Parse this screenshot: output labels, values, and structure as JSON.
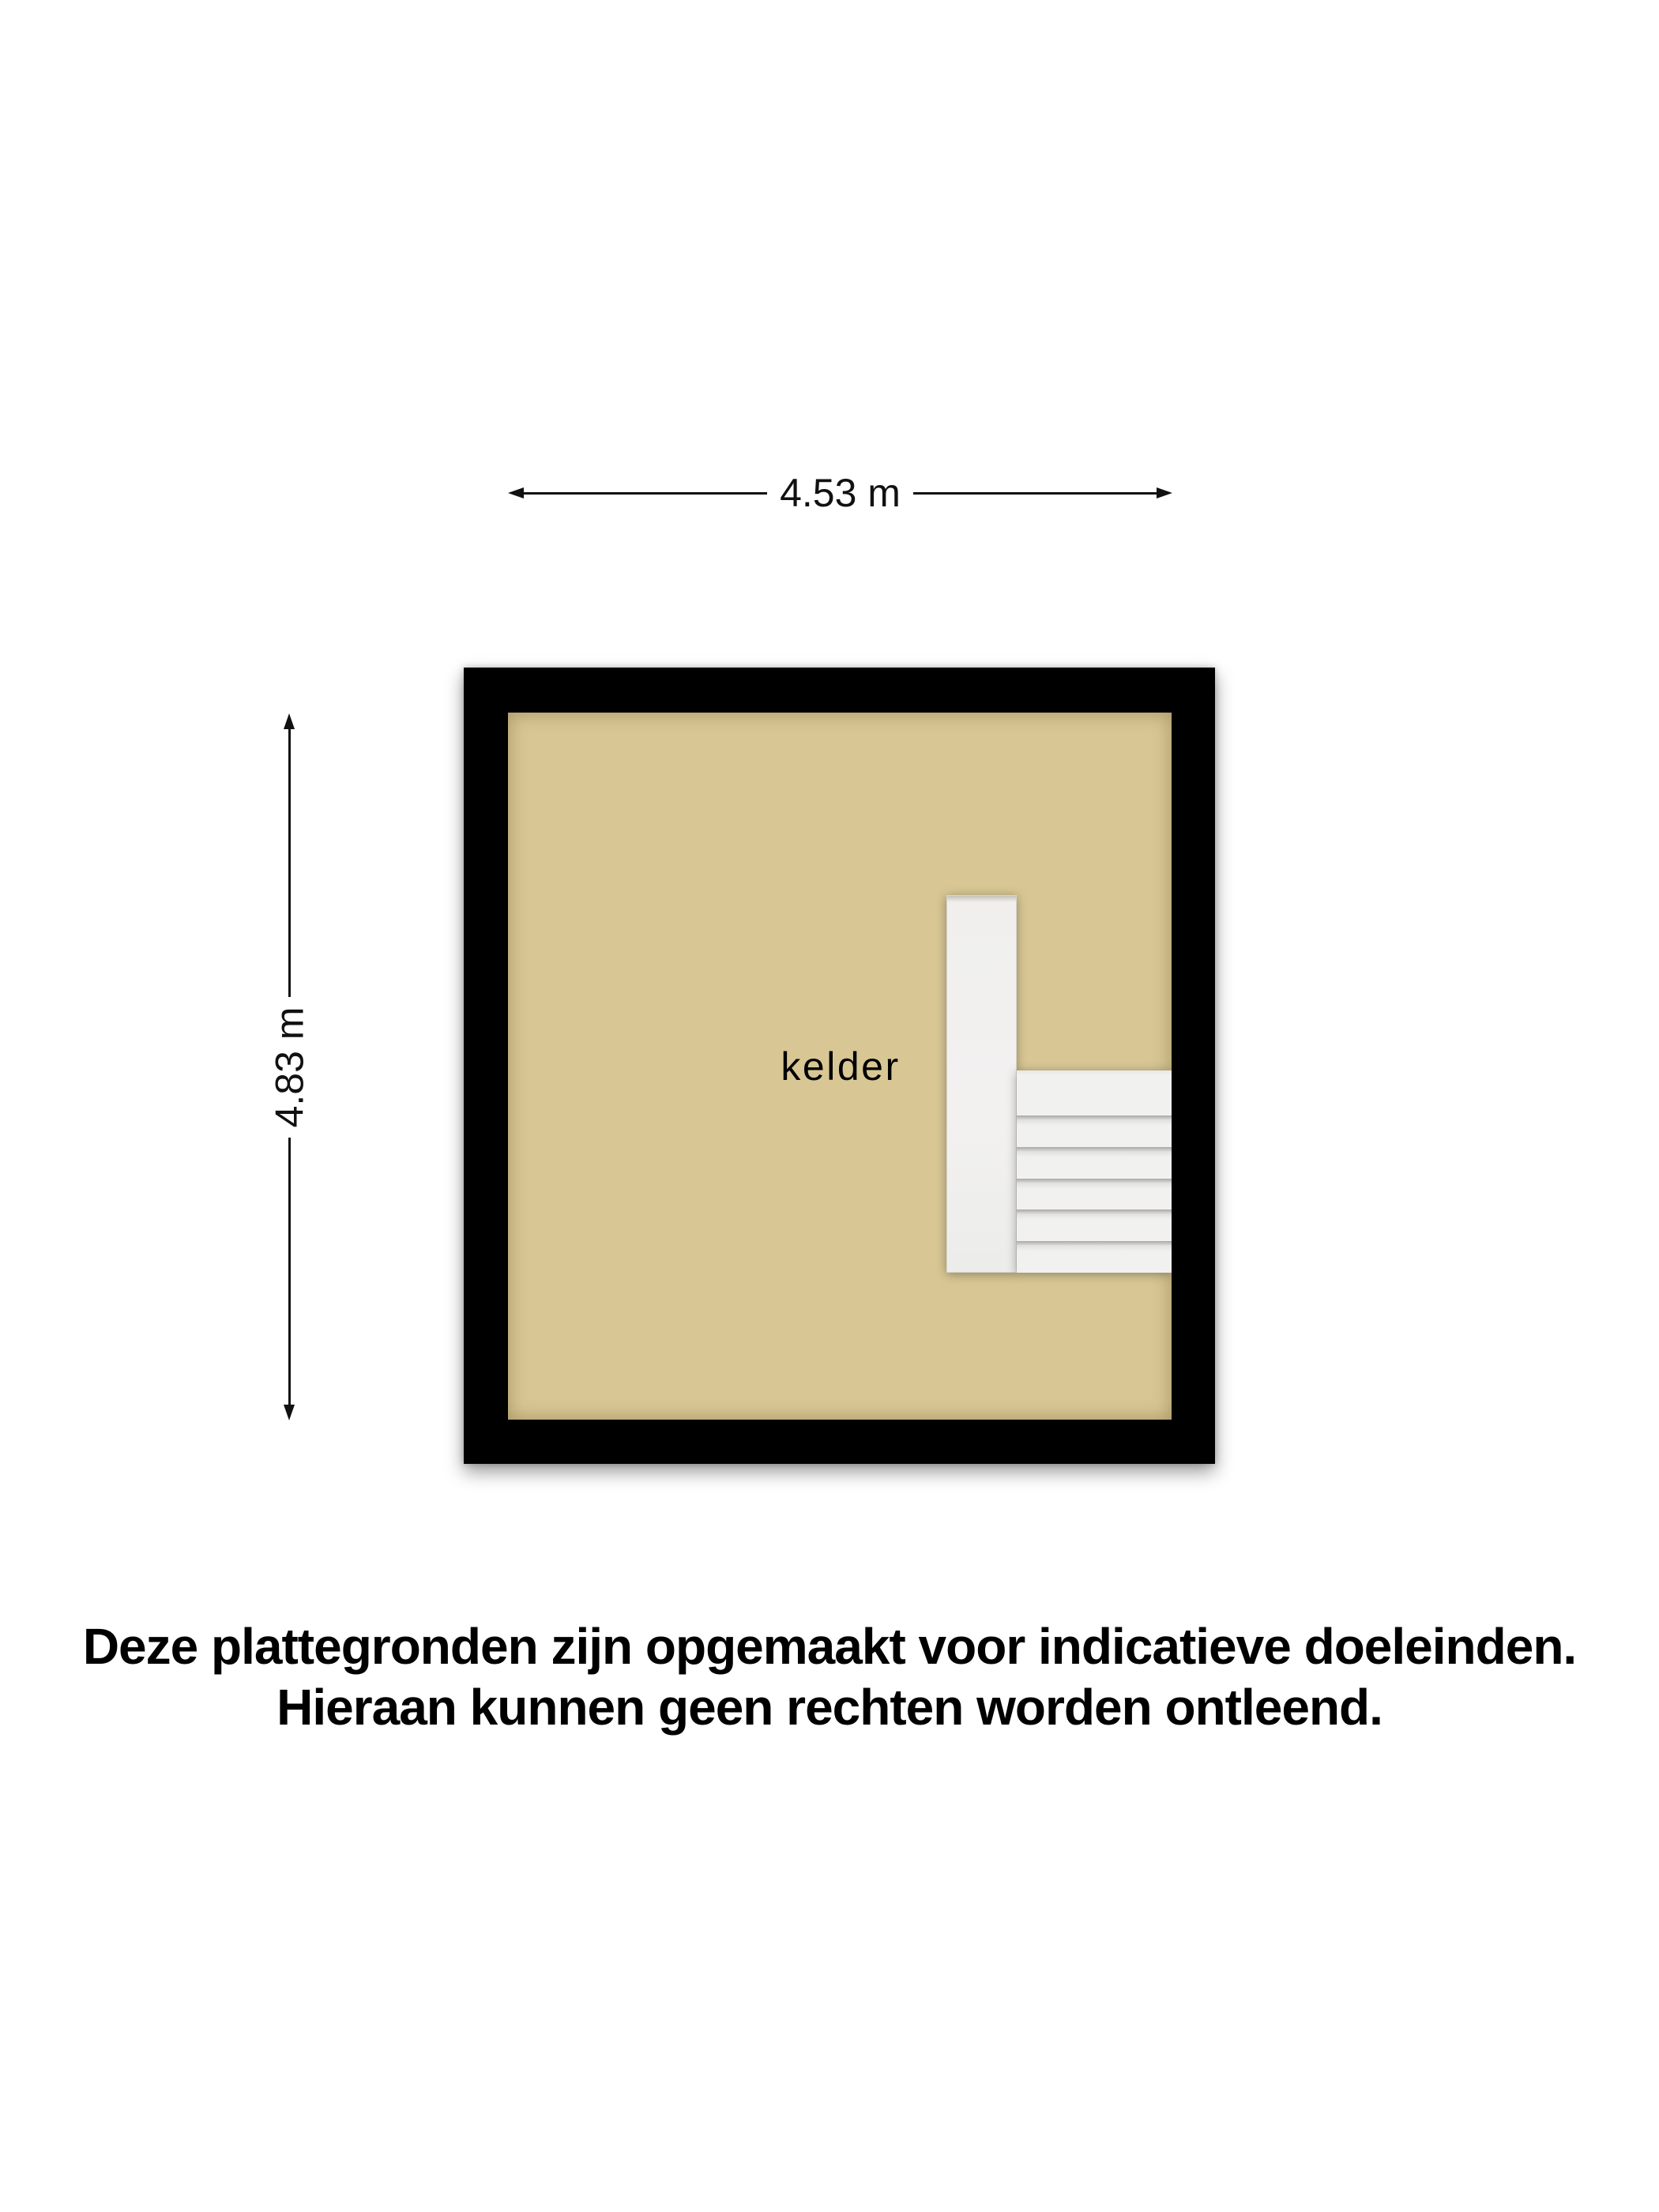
{
  "floorplan": {
    "room_label": "kelder",
    "stairs": {
      "treads": 6
    }
  },
  "dimensions": {
    "width_label": "4.53 m",
    "height_label": "4.83 m"
  },
  "disclaimer": {
    "line1": "Deze plattegronden zijn opgemaakt voor indicatieve doeleinden.",
    "line2": "Hieraan kunnen geen rechten worden ontleend."
  },
  "colors": {
    "wall": "#000000",
    "floor": "#d8c794",
    "stairs": "#f1f1f0",
    "dimension": "#111111",
    "text": "#000000",
    "background": "#ffffff"
  }
}
